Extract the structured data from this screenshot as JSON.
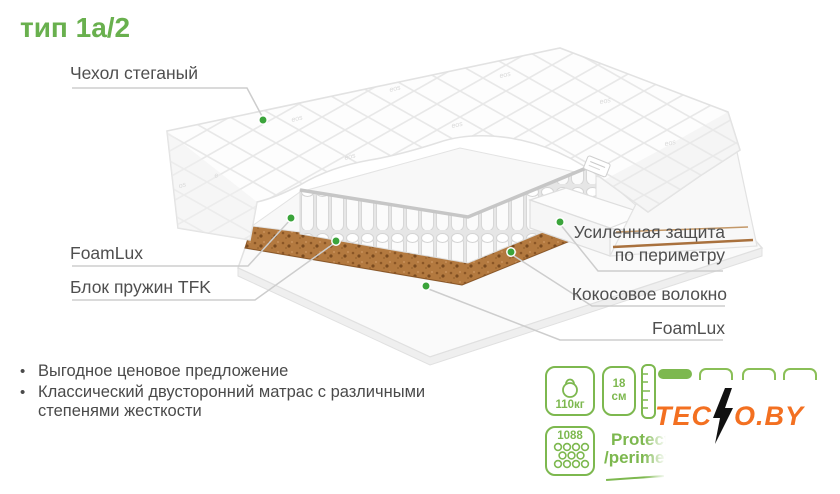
{
  "title": "тип 1а/2",
  "callouts": {
    "cover": "Чехол стеганый",
    "foamlux_left": "FoamLux",
    "springs": "Блок пружин TFK",
    "perimeter_line1": "Усиленная защита",
    "perimeter_line2": "по периметру",
    "coconut": "Кокосовое волокно",
    "foamlux_right": "FoamLux"
  },
  "bullets": [
    "Выгодное ценовое предложение",
    "Классический двусторонний матрас с различными степенями жесткости"
  ],
  "bullet_glyph": "•",
  "features": {
    "max_weight": "110кг",
    "height_value": "18",
    "height_unit": "см",
    "springs_count": "1088",
    "protect_line1": "Protect",
    "protect_line2": "/perimeter",
    "firmness_total": 4,
    "firmness_active": 1
  },
  "brand": {
    "prefix": "TEC",
    "suffix": "O.BY"
  },
  "colors": {
    "accent_green": "#69b04e",
    "icon_green": "#7db84f",
    "dot_green": "#3ba43b",
    "brand_orange": "#f37021",
    "coir_brown": "#b3793f",
    "label_gray": "#4f4f4f",
    "leader_line_gray": "#cdcdcd"
  }
}
